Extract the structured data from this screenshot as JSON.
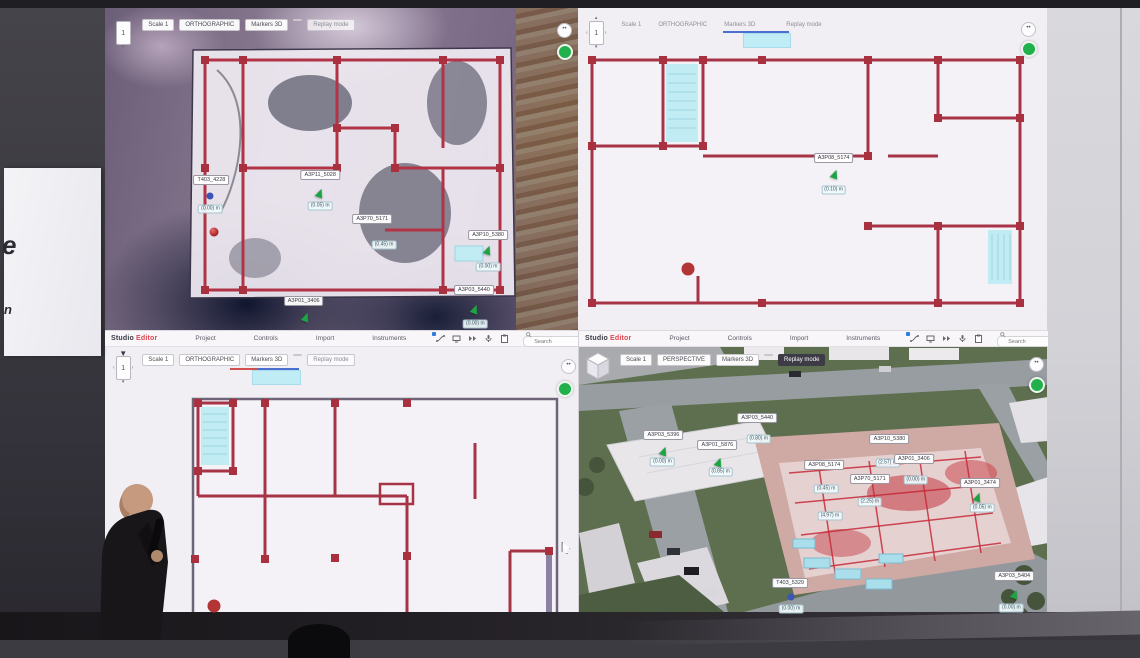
{
  "stage": {
    "side_screen_letters": [
      "e",
      "n"
    ]
  },
  "app": {
    "brand_studio": "Studio",
    "brand_editor": "Editor",
    "menus": [
      "Project",
      "Controls",
      "Import",
      "Instruments"
    ],
    "icons": [
      "spline-icon",
      "monitor-icon",
      "playback-icon",
      "mic-icon",
      "clipboard-icon",
      "search-icon"
    ],
    "search_placeholder": "Search"
  },
  "colors": {
    "accent_red": "#e0474f",
    "wall_red": "#a63446",
    "marker_green": "#1ea344",
    "status_green": "#21b14c",
    "stair_cyan": "#c2ecf4",
    "replay_active_bg": "#3c3b46"
  },
  "quadrants": [
    {
      "position": "top-left",
      "nav": "1",
      "chips": {
        "scale": "Scale 1",
        "view": "ORTHOGRAPHIC",
        "markers3d": "Markers 3D",
        "replay": "Replay mode"
      },
      "markers": [
        {
          "t": "label",
          "x": 22.5,
          "y": 53.5,
          "text": "T403_4228"
        },
        {
          "t": "dotblue",
          "x": 22.3,
          "y": 58.5
        },
        {
          "t": "tag",
          "x": 22.3,
          "y": 62.5,
          "text": "(0.00) m"
        },
        {
          "t": "dotred",
          "x": 23.0,
          "y": 69.5
        },
        {
          "t": "label",
          "x": 45.5,
          "y": 52.0,
          "text": "A3P11_5028"
        },
        {
          "t": "arrow",
          "x": 45.5,
          "y": 57.5
        },
        {
          "t": "tag",
          "x": 45.5,
          "y": 61.5,
          "text": "(0.05) m"
        },
        {
          "t": "label",
          "x": 56.5,
          "y": 65.5,
          "text": "A3P70_5171"
        },
        {
          "t": "tag",
          "x": 59.0,
          "y": 73.5,
          "text": "(0.45) m"
        },
        {
          "t": "label",
          "x": 81.0,
          "y": 70.5,
          "text": "A3P10_5380"
        },
        {
          "t": "arrow",
          "x": 81.0,
          "y": 75.0
        },
        {
          "t": "tag",
          "x": 81.0,
          "y": 80.5,
          "text": "(0.00) m"
        },
        {
          "t": "label",
          "x": 42.0,
          "y": 91.0,
          "text": "A3P01_3406"
        },
        {
          "t": "arrow",
          "x": 42.5,
          "y": 96.0
        },
        {
          "t": "label",
          "x": 78.0,
          "y": 87.5,
          "text": "A3P03_5440"
        },
        {
          "t": "arrow",
          "x": 78.3,
          "y": 93.5
        },
        {
          "t": "tag",
          "x": 78.3,
          "y": 98.0,
          "text": "(0.00) m"
        }
      ]
    },
    {
      "position": "top-right",
      "nav": "1",
      "chips": {
        "scale": "Scale 1",
        "view": "ORTHOGRAPHIC",
        "markers3d": "Markers 3D",
        "replay": "Replay mode"
      },
      "markers": [
        {
          "t": "label",
          "x": 54.5,
          "y": 46.5,
          "text": "A3P08_5174"
        },
        {
          "t": "arrow",
          "x": 54.8,
          "y": 51.5
        },
        {
          "t": "tag",
          "x": 54.5,
          "y": 56.5,
          "text": "(0.10) m"
        },
        {
          "t": "circlered",
          "x": 23.5,
          "y": 81.0
        }
      ]
    },
    {
      "position": "bottom-left",
      "nav": "1",
      "chips": {
        "scale": "Scale 1",
        "view": "ORTHOGRAPHIC",
        "markers3d": "Markers 3D",
        "replay": "Replay mode"
      },
      "markers": [
        {
          "t": "circlered",
          "x": 23.0,
          "y": 96.5
        },
        {
          "t": "cursor",
          "x": 97.5,
          "y": 76.0
        }
      ]
    },
    {
      "position": "bottom-right",
      "nav": "1",
      "chips": {
        "scale": "Scale 1",
        "view": "PERSPECTIVE",
        "markers3d": "Markers 3D",
        "replay": "Replay mode"
      },
      "markers": [
        {
          "t": "label",
          "x": 18.0,
          "y": 36.5,
          "text": "A3P03_5396"
        },
        {
          "t": "arrow",
          "x": 18.2,
          "y": 42.0
        },
        {
          "t": "tag",
          "x": 17.8,
          "y": 46.0,
          "text": "(0.00) m"
        },
        {
          "t": "label",
          "x": 29.5,
          "y": 40.0,
          "text": "A3P01_5876"
        },
        {
          "t": "arrow",
          "x": 29.8,
          "y": 45.8
        },
        {
          "t": "tag",
          "x": 30.2,
          "y": 49.5,
          "text": "(0.85) m"
        },
        {
          "t": "label",
          "x": 38.0,
          "y": 30.5,
          "text": "A3P03_5440"
        },
        {
          "t": "tag",
          "x": 38.3,
          "y": 38.0,
          "text": "(0.80) m"
        },
        {
          "t": "label",
          "x": 52.3,
          "y": 47.0,
          "text": "A3P08_5174"
        },
        {
          "t": "tag",
          "x": 52.7,
          "y": 55.3,
          "text": "(0.45) m"
        },
        {
          "t": "tag",
          "x": 53.5,
          "y": 65.0,
          "text": "(4.97) m"
        },
        {
          "t": "label",
          "x": 62.0,
          "y": 52.0,
          "text": "A3P70_5171"
        },
        {
          "t": "tag",
          "x": 62.0,
          "y": 60.0,
          "text": "(2.25) m"
        },
        {
          "t": "label",
          "x": 66.2,
          "y": 38.0,
          "text": "A3P10_5380"
        },
        {
          "t": "tag",
          "x": 65.8,
          "y": 46.2,
          "text": "(2.57) m"
        },
        {
          "t": "label",
          "x": 71.4,
          "y": 44.8,
          "text": "A3P01_3406"
        },
        {
          "t": "tag",
          "x": 71.8,
          "y": 52.2,
          "text": "(0.00) m"
        },
        {
          "t": "label",
          "x": 85.5,
          "y": 53.2,
          "text": "A3P01_3474"
        },
        {
          "t": "arrow",
          "x": 85.0,
          "y": 58.4
        },
        {
          "t": "tag",
          "x": 86.0,
          "y": 62.2,
          "text": "(0.05) m"
        },
        {
          "t": "label",
          "x": 45.0,
          "y": 88.5,
          "text": "T403_5329"
        },
        {
          "t": "dotblue",
          "x": 45.2,
          "y": 93.5
        },
        {
          "t": "tag",
          "x": 45.2,
          "y": 97.5,
          "text": "(0.00) m"
        },
        {
          "t": "label",
          "x": 92.8,
          "y": 85.8,
          "text": "A3P03_5404"
        },
        {
          "t": "arrow",
          "x": 93.0,
          "y": 92.4
        },
        {
          "t": "tag",
          "x": 92.2,
          "y": 97.2,
          "text": "(0.00) m"
        }
      ]
    }
  ]
}
